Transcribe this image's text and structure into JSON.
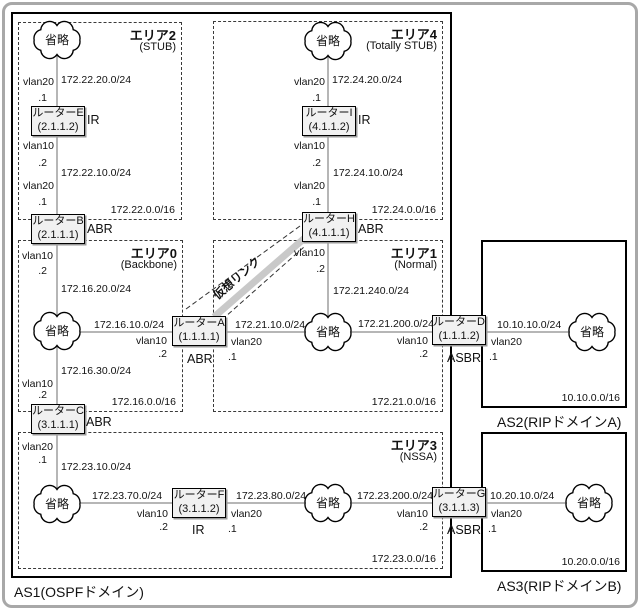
{
  "canvas": {
    "width": 640,
    "height": 610
  },
  "diagram": {
    "cloud_label": "省略",
    "virtual_link_label": "仮想リンク",
    "areas": [
      {
        "id": "area2",
        "title": "エリア2",
        "subtitle": "(STUB)",
        "network": "172.22.0.0/16",
        "x": 18,
        "y": 22,
        "w": 164,
        "h": 198,
        "border": "dashed"
      },
      {
        "id": "area4",
        "title": "エリア4",
        "subtitle": "(Totally STUB)",
        "network": "172.24.0.0/16",
        "x": 213,
        "y": 21,
        "w": 230,
        "h": 199,
        "border": "dashed"
      },
      {
        "id": "area0",
        "title": "エリア0",
        "subtitle": "(Backbone)",
        "network": "172.16.0.0/16",
        "x": 18,
        "y": 240,
        "w": 165,
        "h": 172,
        "border": "dashed"
      },
      {
        "id": "area1",
        "title": "エリア1",
        "subtitle": "(Normal)",
        "network": "172.21.0.0/16",
        "x": 213,
        "y": 240,
        "w": 230,
        "h": 172,
        "border": "dashed"
      },
      {
        "id": "area3",
        "title": "エリア3",
        "subtitle": "(NSSA)",
        "network": "172.23.0.0/16",
        "x": 18,
        "y": 432,
        "w": 425,
        "h": 137,
        "border": "dashed"
      },
      {
        "id": "as1",
        "outside_label": "AS1(OSPFドメイン)",
        "x": 11,
        "y": 12,
        "w": 441,
        "h": 566,
        "border": "solid"
      },
      {
        "id": "as2",
        "outside_label": "AS2(RIPドメインA)",
        "network": "10.10.0.0/16",
        "x": 481,
        "y": 240,
        "w": 146,
        "h": 168,
        "border": "solid"
      },
      {
        "id": "as3",
        "outside_label": "AS3(RIPドメインB)",
        "network": "10.20.0.0/16",
        "x": 481,
        "y": 432,
        "w": 146,
        "h": 140,
        "border": "solid"
      }
    ],
    "routers": [
      {
        "id": "E",
        "name": "ルーターE",
        "rid": "(2.1.1.2)",
        "role": "IR",
        "x": 31,
        "y": 106,
        "rx": 87,
        "ry": 113
      },
      {
        "id": "B",
        "name": "ルーターB",
        "rid": "(2.1.1.1)",
        "role": "ABR",
        "x": 31,
        "y": 214,
        "rx": 87,
        "ry": 222
      },
      {
        "id": "C",
        "name": "ルーターC",
        "rid": "(3.1.1.1)",
        "role": "ABR",
        "x": 31,
        "y": 404,
        "rx": 86,
        "ry": 415
      },
      {
        "id": "A",
        "name": "ルーターA",
        "rid": "(1.1.1.1)",
        "role": "ABR",
        "x": 172,
        "y": 316,
        "rx": 187,
        "ry": 352
      },
      {
        "id": "F",
        "name": "ルーターF",
        "rid": "(3.1.1.2)",
        "role": "IR",
        "x": 172,
        "y": 488,
        "rx": 192,
        "ry": 523
      },
      {
        "id": "H",
        "name": "ルーターH",
        "rid": "(4.1.1.1)",
        "role": "ABR",
        "x": 302,
        "y": 212,
        "rx": 358,
        "ry": 222
      },
      {
        "id": "I",
        "name": "ルーターI",
        "rid": "(4.1.1.2)",
        "role": "IR",
        "x": 302,
        "y": 106,
        "rx": 358,
        "ry": 113
      },
      {
        "id": "D",
        "name": "ルーターD",
        "rid": "(1.1.1.2)",
        "role": "ASBR",
        "x": 432,
        "y": 315,
        "rx": 447,
        "ry": 351
      },
      {
        "id": "G",
        "name": "ルーターG",
        "rid": "(3.1.1.3)",
        "role": "ASBR",
        "x": 432,
        "y": 487,
        "rx": 447,
        "ry": 523
      }
    ],
    "clouds": [
      {
        "id": "c1",
        "x": 57,
        "y": 40
      },
      {
        "id": "c2",
        "x": 328,
        "y": 41
      },
      {
        "id": "c3",
        "x": 57,
        "y": 331
      },
      {
        "id": "c4",
        "x": 328,
        "y": 332
      },
      {
        "id": "c5",
        "x": 57,
        "y": 504
      },
      {
        "id": "c6",
        "x": 328,
        "y": 503
      },
      {
        "id": "c7",
        "x": 592,
        "y": 332
      },
      {
        "id": "c8",
        "x": 589,
        "y": 503
      }
    ],
    "link_labels": [
      {
        "t": "vlan20",
        "x": 54,
        "y": 76,
        "a": "r"
      },
      {
        "t": ".1",
        "x": 47,
        "y": 92,
        "a": "r"
      },
      {
        "t": "172.22.20.0/24",
        "x": 61,
        "y": 74,
        "a": "l"
      },
      {
        "t": "vlan10",
        "x": 54,
        "y": 140,
        "a": "r"
      },
      {
        "t": ".2",
        "x": 47,
        "y": 157,
        "a": "r"
      },
      {
        "t": "172.22.10.0/24",
        "x": 61,
        "y": 167,
        "a": "l"
      },
      {
        "t": "vlan20",
        "x": 54,
        "y": 180,
        "a": "r"
      },
      {
        "t": ".1",
        "x": 47,
        "y": 196,
        "a": "r"
      },
      {
        "t": "vlan10",
        "x": 53,
        "y": 250,
        "a": "r"
      },
      {
        "t": ".2",
        "x": 47,
        "y": 265,
        "a": "r"
      },
      {
        "t": "172.16.20.0/24",
        "x": 61,
        "y": 283,
        "a": "l"
      },
      {
        "t": "172.16.30.0/24",
        "x": 61,
        "y": 365,
        "a": "l"
      },
      {
        "t": "vlan10",
        "x": 53,
        "y": 378,
        "a": "r"
      },
      {
        "t": ".2",
        "x": 47,
        "y": 389,
        "a": "r"
      },
      {
        "t": "vlan20",
        "x": 53,
        "y": 441,
        "a": "r"
      },
      {
        "t": ".1",
        "x": 47,
        "y": 454,
        "a": "r"
      },
      {
        "t": "172.23.10.0/24",
        "x": 61,
        "y": 461,
        "a": "l"
      },
      {
        "t": "vlan20",
        "x": 325,
        "y": 76,
        "a": "r"
      },
      {
        "t": ".1",
        "x": 321,
        "y": 92,
        "a": "r"
      },
      {
        "t": "172.24.20.0/24",
        "x": 332,
        "y": 74,
        "a": "l"
      },
      {
        "t": "vlan10",
        "x": 325,
        "y": 140,
        "a": "r"
      },
      {
        "t": ".2",
        "x": 321,
        "y": 157,
        "a": "r"
      },
      {
        "t": "172.24.10.0/24",
        "x": 333,
        "y": 167,
        "a": "l"
      },
      {
        "t": "vlan20",
        "x": 325,
        "y": 180,
        "a": "r"
      },
      {
        "t": ".1",
        "x": 321,
        "y": 196,
        "a": "r"
      },
      {
        "t": "vlan10",
        "x": 325,
        "y": 247,
        "a": "r"
      },
      {
        "t": ".2",
        "x": 325,
        "y": 263,
        "a": "r"
      },
      {
        "t": "172.21.240.0/24",
        "x": 333,
        "y": 285,
        "a": "l"
      },
      {
        "t": "172.16.10.0/24",
        "x": 94,
        "y": 319,
        "a": "l"
      },
      {
        "t": "vlan10",
        "x": 167,
        "y": 335,
        "a": "r"
      },
      {
        "t": ".2",
        "x": 167,
        "y": 348,
        "a": "r"
      },
      {
        "t": "172.21.10.0/24",
        "x": 235,
        "y": 319,
        "a": "l"
      },
      {
        "t": "vlan20",
        "x": 231,
        "y": 336,
        "a": "l"
      },
      {
        "t": ".1",
        "x": 228,
        "y": 351,
        "a": "l"
      },
      {
        "t": "172.21.200.0/24",
        "x": 358,
        "y": 318,
        "a": "l"
      },
      {
        "t": "vlan10",
        "x": 428,
        "y": 335,
        "a": "r"
      },
      {
        "t": ".2",
        "x": 428,
        "y": 348,
        "a": "r"
      },
      {
        "t": "10.10.10.0/24",
        "x": 497,
        "y": 319,
        "a": "l"
      },
      {
        "t": "vlan20",
        "x": 491,
        "y": 336,
        "a": "l"
      },
      {
        "t": ".1",
        "x": 489,
        "y": 351,
        "a": "l"
      },
      {
        "t": "172.23.70.0/24",
        "x": 92,
        "y": 490,
        "a": "l"
      },
      {
        "t": "vlan10",
        "x": 168,
        "y": 508,
        "a": "r"
      },
      {
        "t": ".2",
        "x": 168,
        "y": 521,
        "a": "r"
      },
      {
        "t": "172.23.80.0/24",
        "x": 236,
        "y": 490,
        "a": "l"
      },
      {
        "t": "vlan20",
        "x": 231,
        "y": 508,
        "a": "l"
      },
      {
        "t": ".1",
        "x": 228,
        "y": 523,
        "a": "l"
      },
      {
        "t": "172.23.200.0/24",
        "x": 357,
        "y": 490,
        "a": "l"
      },
      {
        "t": "vlan10",
        "x": 428,
        "y": 508,
        "a": "r"
      },
      {
        "t": ".2",
        "x": 428,
        "y": 521,
        "a": "r"
      },
      {
        "t": "10.20.10.0/24",
        "x": 490,
        "y": 490,
        "a": "l"
      },
      {
        "t": "vlan20",
        "x": 491,
        "y": 508,
        "a": "l"
      },
      {
        "t": ".1",
        "x": 488,
        "y": 523,
        "a": "l"
      }
    ]
  }
}
